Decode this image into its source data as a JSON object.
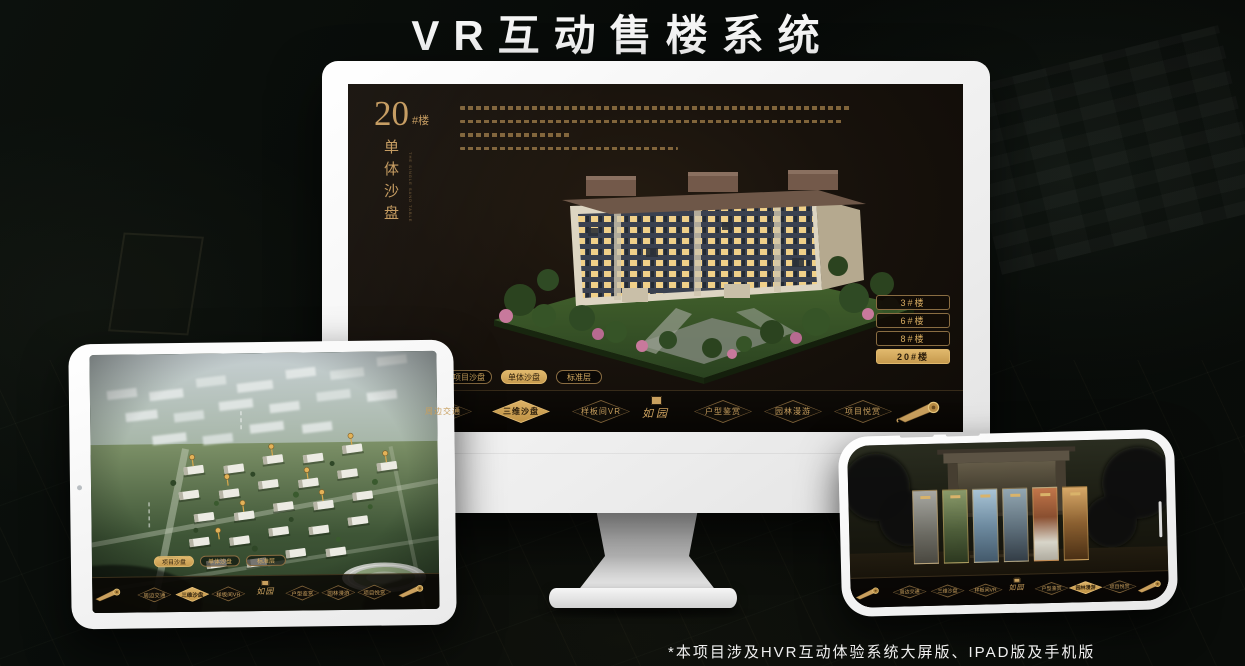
{
  "page": {
    "title": "VR互动售楼系统",
    "footnote": "*本项目涉及HVR互动体验系统大屏版、IPAD版及手机版"
  },
  "colors": {
    "gold": "#c89f5e",
    "gold_bright": "#e6c179",
    "screen_bg": "#17110b"
  },
  "monitor": {
    "screen": {
      "heading": {
        "number": "20",
        "suffix": "#楼",
        "name": "单体沙盘",
        "name_en": "THE SINGLE SAND TABLE"
      },
      "building_buttons": [
        {
          "label": "3#楼",
          "active": false
        },
        {
          "label": "6#楼",
          "active": false
        },
        {
          "label": "8#楼",
          "active": false
        },
        {
          "label": "20#楼",
          "active": true
        }
      ],
      "tabs": [
        {
          "label": "项目沙盘",
          "active": false
        },
        {
          "label": "单体沙盘",
          "active": true
        },
        {
          "label": "标准层",
          "active": false
        }
      ],
      "nav": {
        "logo": "如园",
        "items": [
          {
            "label": "周边交通",
            "active": false
          },
          {
            "label": "三维沙盘",
            "active": true
          },
          {
            "label": "样板间VR",
            "active": false
          },
          {
            "label": "户型鉴赏",
            "active": false
          },
          {
            "label": "园林漫游",
            "active": false
          },
          {
            "label": "项目悦赏",
            "active": false
          }
        ]
      }
    }
  },
  "ipad": {
    "screen": {
      "tabs": [
        {
          "label": "项目沙盘",
          "active": true
        },
        {
          "label": "单体沙盘",
          "active": false
        },
        {
          "label": "标准层",
          "active": false
        }
      ],
      "nav": {
        "logo": "如园",
        "items": [
          {
            "label": "周边交通",
            "active": false
          },
          {
            "label": "三维沙盘",
            "active": true
          },
          {
            "label": "样板间VR",
            "active": false
          },
          {
            "label": "户型鉴赏",
            "active": false
          },
          {
            "label": "园林漫游",
            "active": false
          },
          {
            "label": "项目悦赏",
            "active": false
          }
        ]
      }
    }
  },
  "phone": {
    "screen": {
      "panel_count": 6,
      "nav": {
        "logo": "如园",
        "items": [
          {
            "label": "周边交通",
            "active": false
          },
          {
            "label": "三维沙盘",
            "active": false
          },
          {
            "label": "样板间VR",
            "active": false
          },
          {
            "label": "户型鉴赏",
            "active": false
          },
          {
            "label": "园林漫游",
            "active": true
          },
          {
            "label": "项目悦赏",
            "active": false
          }
        ]
      }
    }
  }
}
